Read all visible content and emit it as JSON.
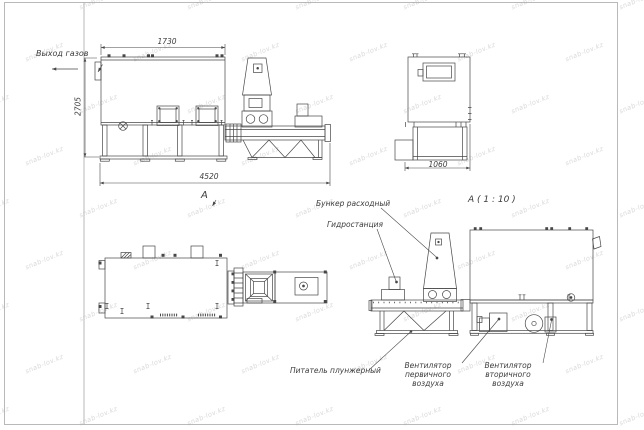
{
  "drawing": {
    "view_a_title": "А ( 1 : 10 )",
    "view_a_marker": "А",
    "dimensions": {
      "top_length": "1730",
      "overall_length": "4520",
      "overall_height": "2705",
      "front_width": "1060"
    },
    "annotations": {
      "gas_outlet": "Выход газов",
      "feed_hopper": "Бункер расходный",
      "hydraulic_station": "Гидростанция",
      "plunger_feeder": "Питатель плунжерный",
      "primary_fan_line1": "Вентилятор",
      "primary_fan_line2": "первичного воздуха",
      "secondary_fan_line1": "Вентилятор",
      "secondary_fan_line2": "вторичного воздуха"
    },
    "watermark": {
      "text": "snab-lov.kz"
    },
    "colors": {
      "line": "#474747",
      "frame": "#a8a8a8",
      "text": "#3d3d3d",
      "watermark": "#c9c9c9",
      "background": "#ffffff"
    }
  }
}
